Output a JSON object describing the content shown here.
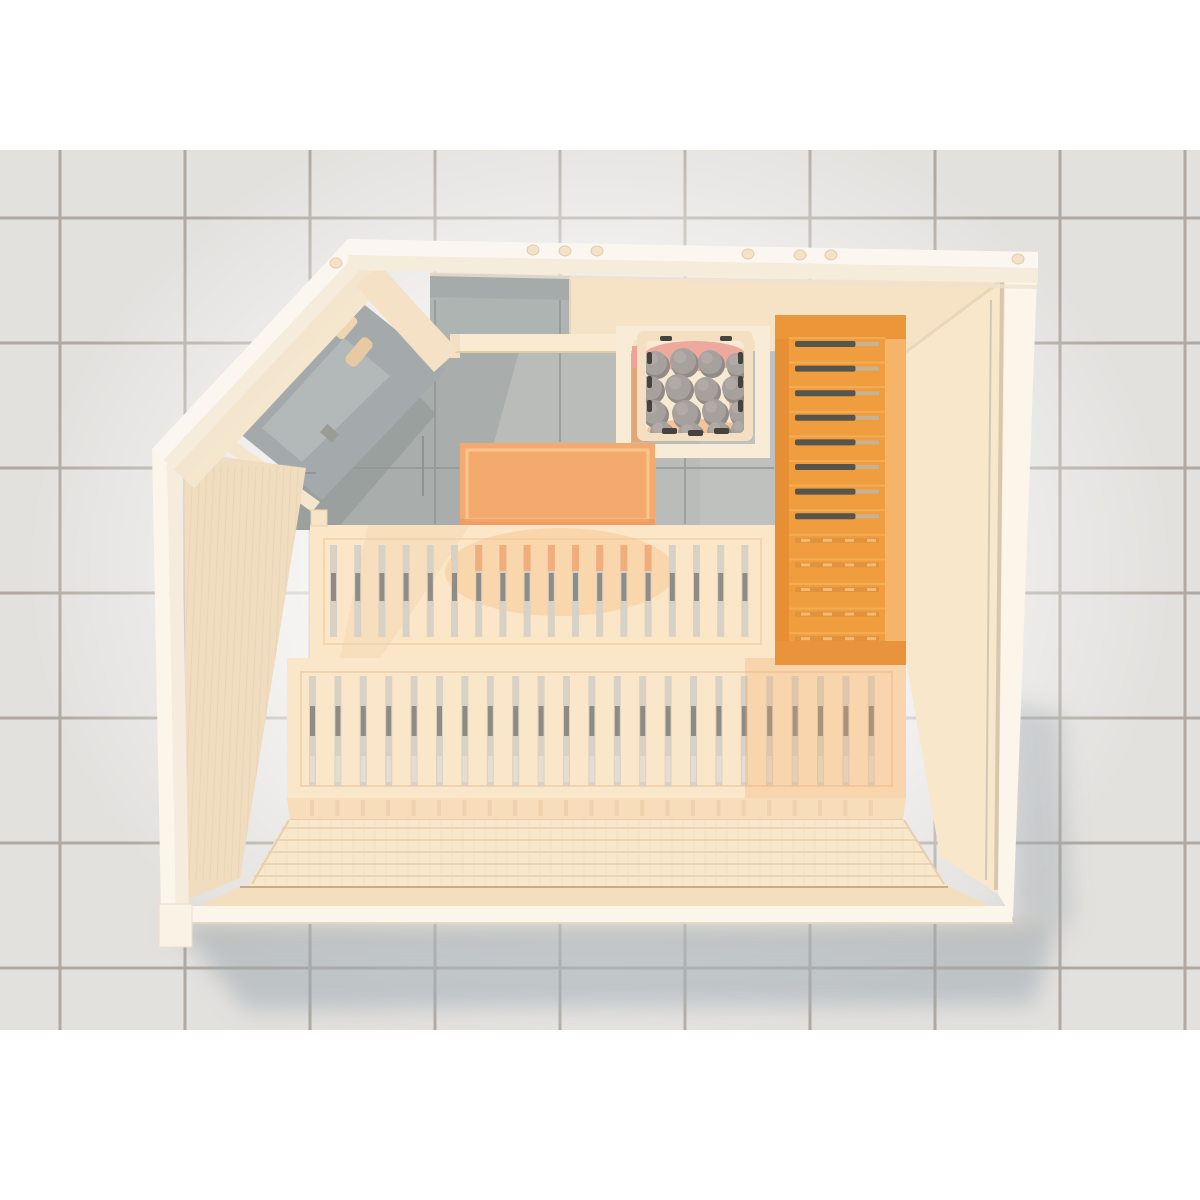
{
  "scene": {
    "title": "sauna-top-view-3d-render",
    "description": "Top-down 3D render of a pentagonal corner-entry sauna on a gray tiled floor; selected accessories highlighted orange",
    "visible_text": [],
    "palette": {
      "background": "#ffffff",
      "tile": "#e3e1de",
      "grout": "#a49c93",
      "shadow": "#9aa6ad",
      "pale_wood": "#f6e3c6",
      "bench_wood": "#fae6c8",
      "roof_white": "#fbf7f0",
      "glass_gray": "#a6acae",
      "interior_gray": "#b9bcb8",
      "highlight_orange": "#ef9d3e",
      "accessory_orange": "#f4aa6e",
      "stone_gray": "#a7a19d",
      "ember_pink": "#ec9e96",
      "ember_orange": "#f1a266"
    },
    "components": [
      {
        "name": "tiled-floor",
        "state": "static"
      },
      {
        "name": "sauna-cabin",
        "state": "dimmed"
      },
      {
        "name": "corner-glass-door",
        "state": "dimmed"
      },
      {
        "name": "door-handle",
        "state": "dimmed"
      },
      {
        "name": "heater-stone-basket",
        "stones": 16,
        "state": "dimmed"
      },
      {
        "name": "heater-guard-rail",
        "state": "dimmed"
      },
      {
        "name": "accessory-panel",
        "state": "highlighted"
      },
      {
        "name": "right-wall-backrest-bench",
        "slats": 13,
        "state": "highlighted"
      },
      {
        "name": "upper-bench",
        "slat_gaps": 18,
        "state": "dimmed"
      },
      {
        "name": "lower-bench",
        "slat_gaps": 23,
        "state": "dimmed"
      },
      {
        "name": "wood-floor-planks",
        "state": "dimmed"
      }
    ]
  },
  "render": {
    "tiles": {
      "top": 150,
      "bottom": 1030,
      "color": "#e3e1de",
      "grout": "#a49c93",
      "vxs": [
        60,
        185,
        310,
        435,
        560,
        685,
        810,
        935,
        1060,
        1185
      ],
      "hys": [
        218,
        343,
        468,
        593,
        718,
        843,
        968
      ]
    },
    "dowels": {
      "fill": "#f3e2c8",
      "edge": "#e2cdae",
      "items": [
        [
          533,
          250
        ],
        [
          565,
          251
        ],
        [
          597,
          251
        ],
        [
          748,
          254
        ],
        [
          800,
          255
        ],
        [
          831,
          255
        ],
        [
          1018,
          259
        ],
        [
          336,
          263
        ]
      ]
    },
    "stones": {
      "fill": "#a7a19d",
      "shade": "#918b87",
      "hi": "#b7b1ad",
      "items": [
        [
          655,
          363,
          13
        ],
        [
          683,
          361,
          14
        ],
        [
          710,
          362,
          13
        ],
        [
          737,
          364,
          12
        ],
        [
          650,
          388,
          13
        ],
        [
          678,
          387,
          14
        ],
        [
          706,
          389,
          13
        ],
        [
          734,
          388,
          13
        ],
        [
          654,
          412,
          13
        ],
        [
          685,
          413,
          14
        ],
        [
          714,
          411,
          13
        ],
        [
          740,
          412,
          12
        ],
        [
          661,
          432,
          12
        ],
        [
          690,
          434,
          13
        ],
        [
          718,
          432,
          12
        ],
        [
          741,
          430,
          11
        ]
      ]
    },
    "backrest": {
      "first_gap_y": 341,
      "pitch": 24.6,
      "count": 13,
      "dark_count": 8,
      "gap_x": 795,
      "gap_w": 84,
      "dark": "#57544b",
      "dark_end": "#c6b394",
      "light": "#e0923c",
      "tick": "#f6bb71",
      "slat_hi": "#f8b760"
    },
    "upper_gaps": {
      "start": 330,
      "pitch": 24.2,
      "count": 18,
      "y": 545,
      "h": 92,
      "fill": "#d8d1c6",
      "dash": "#8f8c85",
      "tint": "#efae7c",
      "tint_from": 468,
      "tint_to": 655
    },
    "lower_gaps": {
      "start": 309,
      "pitch": 25.4,
      "count": 23,
      "y": 676,
      "h": 110,
      "fill": "#d8d1c6",
      "dash": "#8e8b84",
      "low": "#e8e0d4",
      "tick": "#ecd0ab"
    },
    "floor": {
      "plank_ys": [
        828,
        840,
        852,
        864,
        876
      ],
      "plank_color": "#ead4b3",
      "grain_start": 254,
      "grain_end": 934,
      "grain_step": 11,
      "grain_color": "#eed9ba"
    },
    "lwall_grain": {
      "start": 193,
      "end": 299,
      "step": 7,
      "y1": 466,
      "y2": 880,
      "color": "#e4cfb0"
    },
    "interior_grout": {
      "color": "#8f9792",
      "segs": [
        [
          435,
          300,
          435,
          524
        ],
        [
          560,
          300,
          560,
          442
        ],
        [
          685,
          458,
          685,
          524
        ],
        [
          296,
          468,
          459,
          468
        ],
        [
          656,
          468,
          774,
          468
        ],
        [
          423,
          436,
          423,
          496
        ],
        [
          246,
          473,
          316,
          473
        ]
      ]
    }
  }
}
